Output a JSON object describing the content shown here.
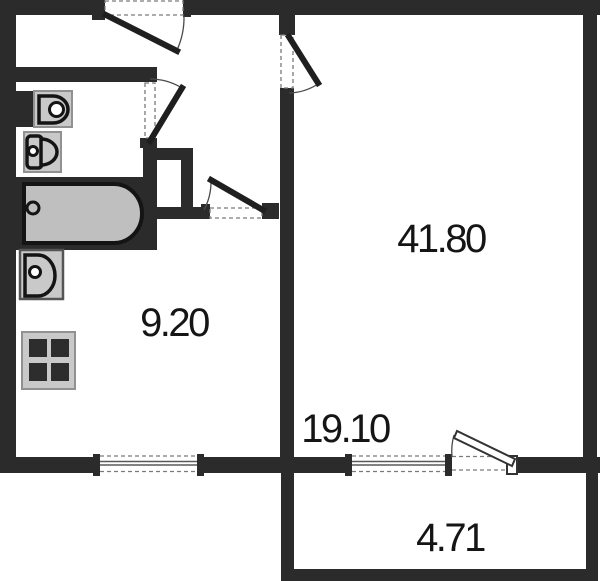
{
  "floorplan": {
    "rooms": [
      {
        "id": "main-room",
        "area": "41.80"
      },
      {
        "id": "kitchen",
        "area": "9.20"
      },
      {
        "id": "room-lower",
        "area": "19.10"
      },
      {
        "id": "balcony",
        "area": "4.71"
      }
    ],
    "colors": {
      "wall": "#2b2b2b",
      "fixture_fill": "#c9c9c9",
      "fixture_outline": "#141414",
      "tub_fill": "#bfbfbf",
      "dashed_line": "#7a7a7a",
      "text": "#151515",
      "background": "#ffffff"
    }
  }
}
